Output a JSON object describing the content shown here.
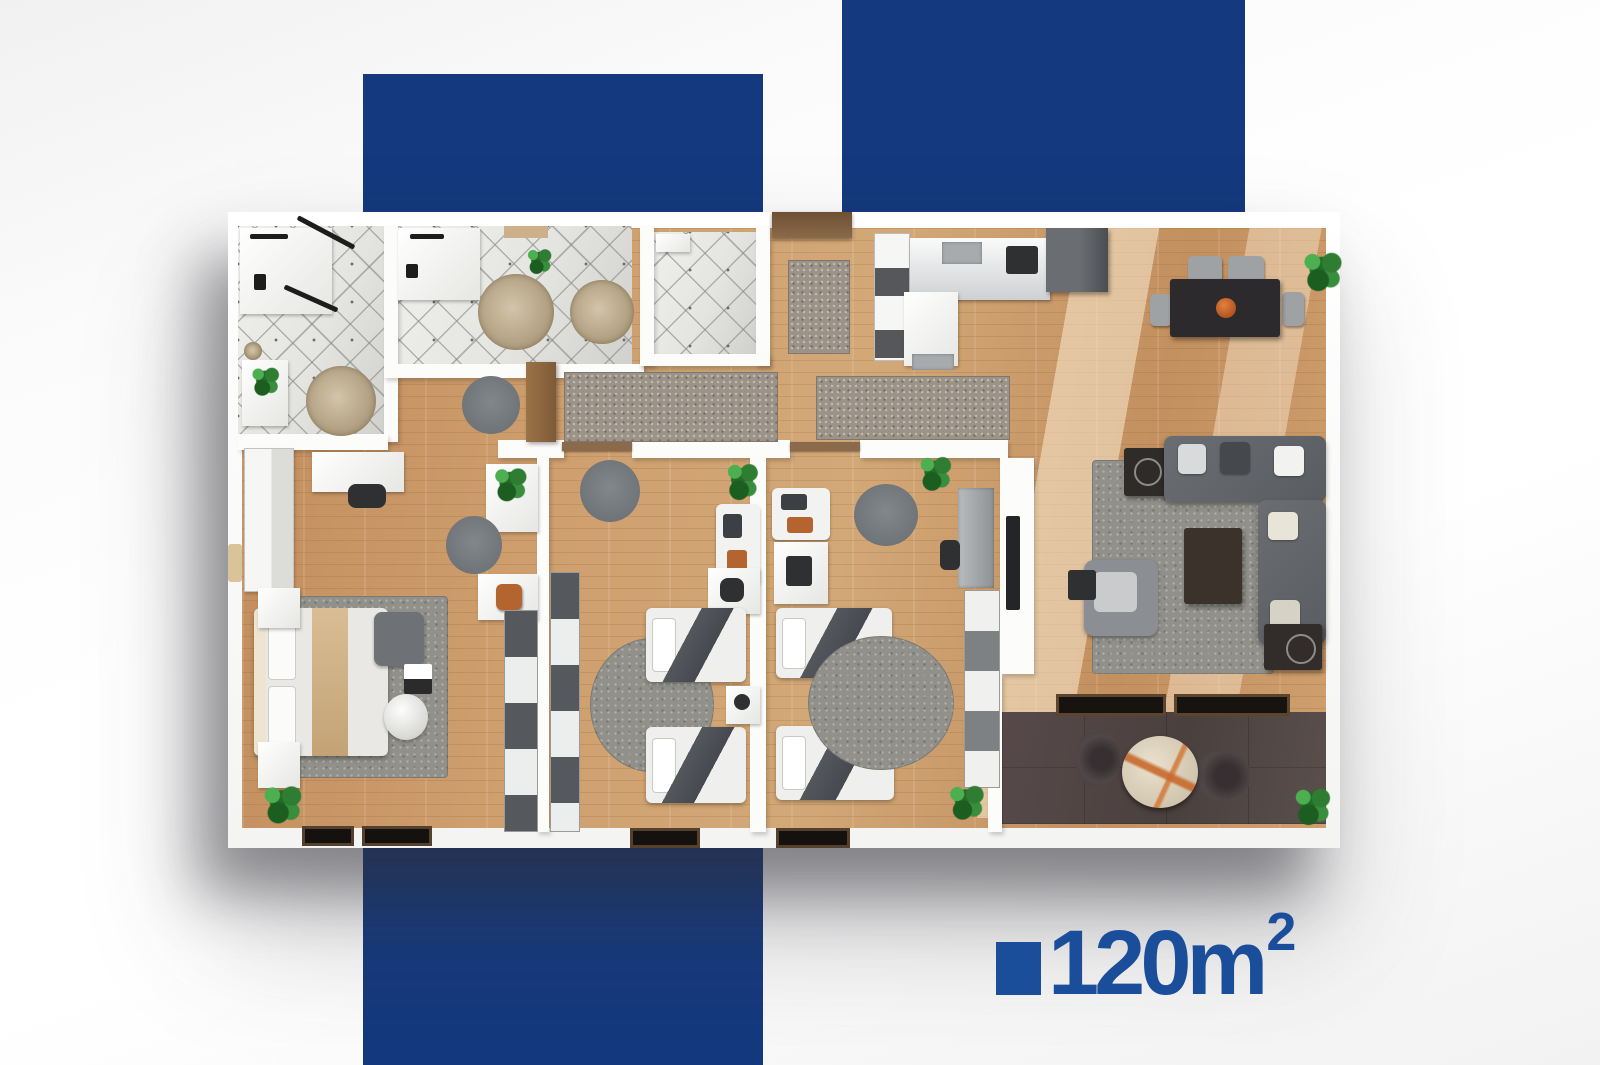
{
  "area_badge": {
    "display": "120m²",
    "value": "120m",
    "exponent": "2",
    "icon": "blue-square"
  },
  "palette": {
    "brand_blue_bar": "#15397e",
    "brand_blue_label": "#1b4e9a",
    "wood_floor": "#cf9f6e",
    "tile_white": "#e9e9e6",
    "balcony_floor": "#4e4440",
    "sofa_gray": "#63666a",
    "rug_gray": "#91908a",
    "plant_green": "#2e7d32",
    "accent_orange": "#c1692f"
  },
  "floor_plan": {
    "description": "3D top-down rendering of a furnished apartment",
    "area_display": "120m²"
  }
}
